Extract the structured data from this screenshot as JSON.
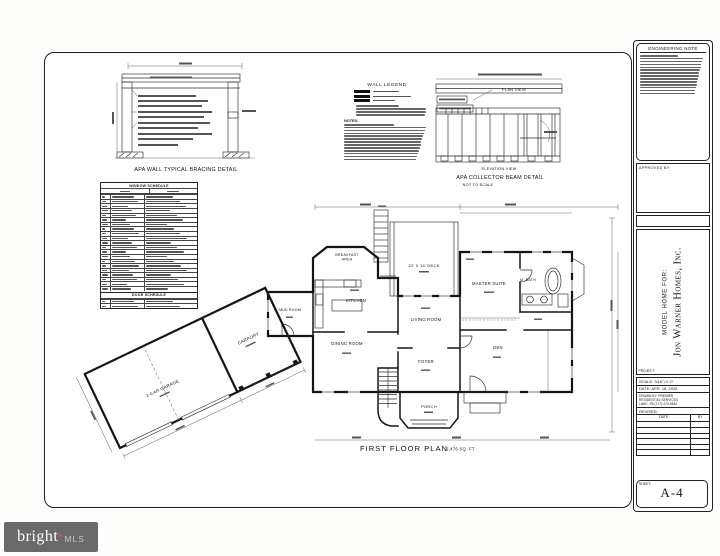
{
  "colors": {
    "ink": "#1a1a1a",
    "paper": "#ffffff",
    "watermark_bg": "#6a6a6a",
    "watermark_star": "#e8622c"
  },
  "details": {
    "bracing_title": "APA WALL TYPICAL BRACING DETAIL",
    "collector_title": "APA COLLECTOR BEAM DETAIL",
    "collector_subtitle": "NOT TO SCALE",
    "plan_view_label": "PLAN VIEW",
    "elevation_view_label": "ELEVATION VIEW",
    "wall_legend_title": "WALL LEGEND",
    "notes_label": "NOTES:",
    "window_schedule_title": "WINDOW SCHEDULE",
    "door_schedule_title": "DOOR SCHEDULE"
  },
  "floor_plan": {
    "title": "FIRST FLOOR PLAN",
    "area": "2,476 SQ. FT.",
    "rooms": {
      "deck": "22' X 14' DECK",
      "breakfast_line1": "BREAKFAST",
      "breakfast_line2": "AREA",
      "kitchen": "KITCHEN",
      "mud_room": "MUD ROOM",
      "dining": "DINING ROOM",
      "living": "LIVING ROOM",
      "foyer": "FOYER",
      "master": "MASTER SUITE",
      "bath": "M. BATH",
      "den": "DEN",
      "porch": "PORCH",
      "carport": "CARPORT",
      "garage": "2-CAR GARAGE"
    }
  },
  "title_block": {
    "engineering_note_title": "ENGINEERING NOTE",
    "approved_by_label": "APPROVED BY:",
    "project_label": "PROJECT:",
    "project_line1": "MODEL HOME FOR:",
    "project_line2": "Jon Warner Homes, Inc.",
    "scale_row": "SCALE:  3/16\"=1'-0\"",
    "date_row": "DATE:  APR. 18, 2025",
    "drawn_by_line1": "DRAWN BY:   PREMIER",
    "drawn_by_line2": "RESIDENTIAL SERVICES",
    "drawn_by_line3": "LANC. PA (717)-470-5542",
    "revised_label": "REVISED:",
    "rev_date_col": "DATE",
    "rev_by_col": "BY",
    "sheet_label": "SHEET:",
    "sheet_number": "A-4"
  },
  "watermark": {
    "brand": "bright",
    "star": "*",
    "suffix": "MLS"
  }
}
